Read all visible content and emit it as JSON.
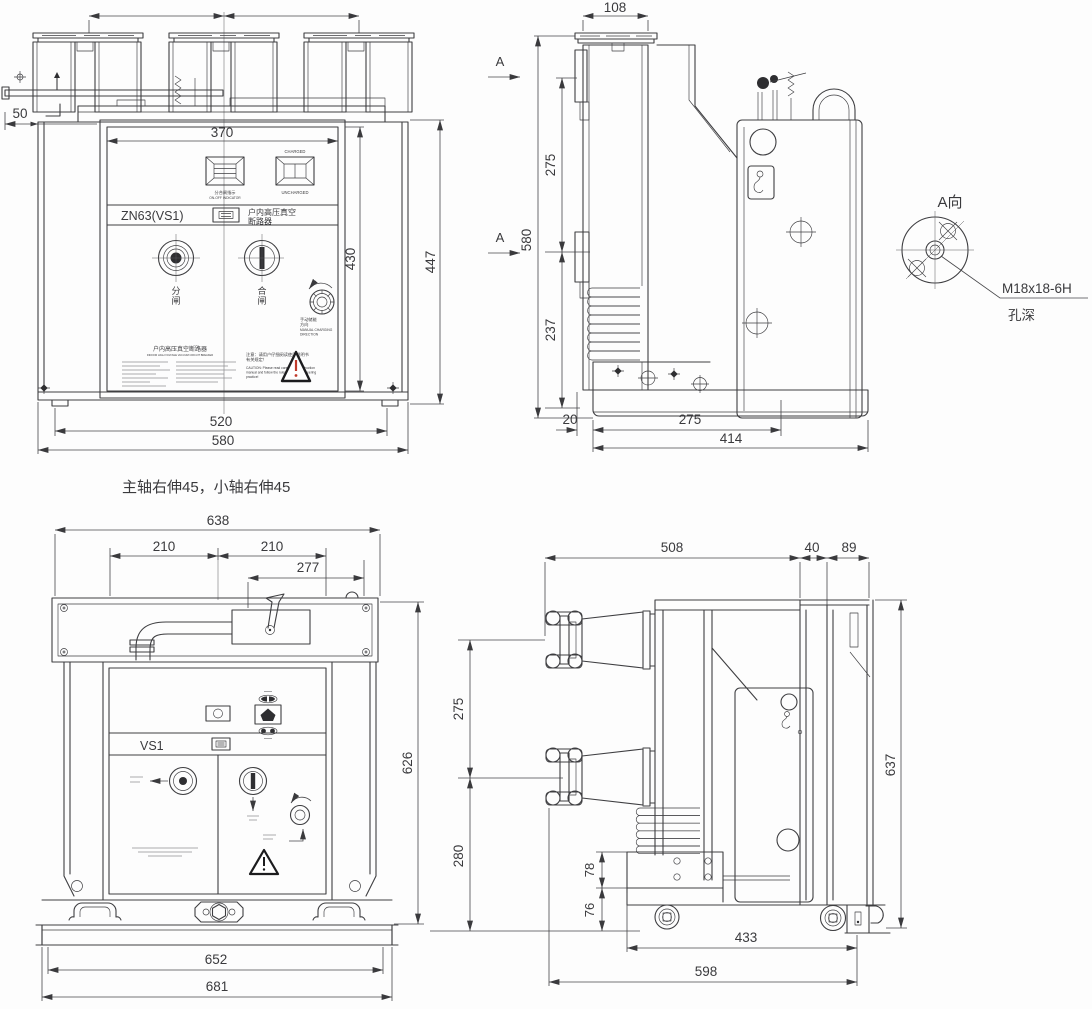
{
  "note": "主轴右伸45，小轴右伸45",
  "v1": {
    "d50": "50",
    "d370": "370",
    "d430": "430",
    "d447": "447",
    "d520": "520",
    "d580": "580",
    "charged": "CHARGED",
    "uncharged": "UNCHARGED",
    "onoff_cn": "分合闸指示",
    "onoff_en": "ON-OFF INDICATOR",
    "model": "ZN63(VS1)",
    "prod1": "户内高压真空",
    "prod2": "断路器",
    "open1": "分",
    "open2": "闸",
    "close1": "合",
    "close2": "闸",
    "man_cn1": "手动储能",
    "man_cn2": "方向",
    "man_en1": "MANUAL CHARGING",
    "man_en2": "DIRECTION",
    "np_title": "户内高压真空断路器",
    "np_sub": "INDOOR HIGH VOLTAGE VACUUM CIRCUIT BREAKER",
    "ca_cn1": "注意：请用户仔细阅读使用说明书",
    "ca_cn2": "有关规定！",
    "ca_en1": "CAUTION: Please read carefully the instruction",
    "ca_en2": "manual and follow the rules of good engineering",
    "ca_en3": "practice!"
  },
  "v2": {
    "d108": "108",
    "d275a": "275",
    "d580": "580",
    "d237": "237",
    "d20": "20",
    "d275b": "275",
    "d414": "414",
    "a_top": "A",
    "a_bot": "A"
  },
  "av": {
    "title": "A向",
    "spec": "M18x18-6H",
    "depth": "孔深"
  },
  "v3": {
    "d638": "638",
    "d210a": "210",
    "d210b": "210",
    "d277": "277",
    "d626": "626",
    "d652": "652",
    "d681": "681",
    "model": "VS1"
  },
  "v4": {
    "d508": "508",
    "d40": "40",
    "d89": "89",
    "d275": "275",
    "d280": "280",
    "d637": "637",
    "d78": "78",
    "d76": "76",
    "d433": "433",
    "d598": "598"
  }
}
